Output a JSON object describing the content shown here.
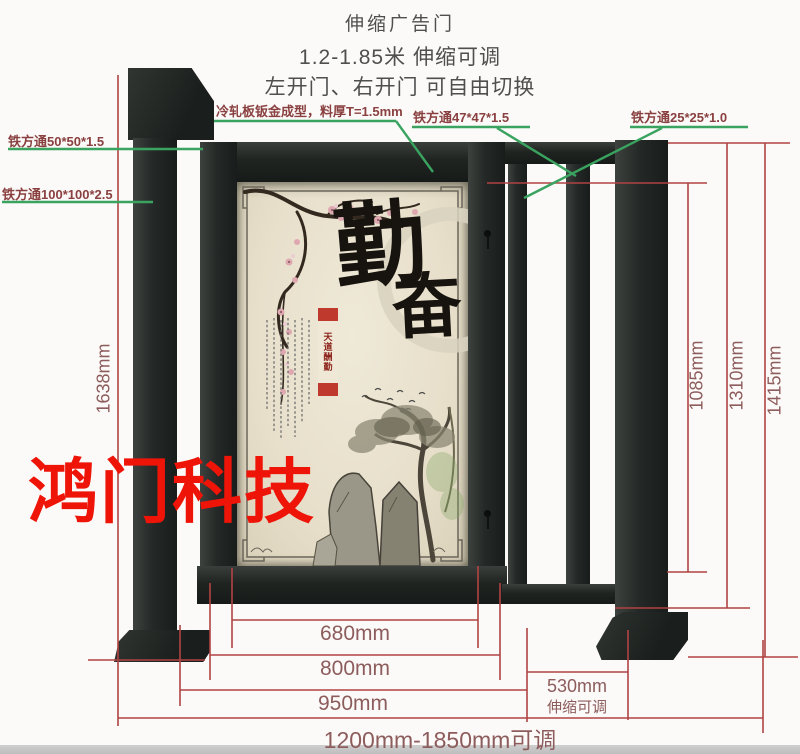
{
  "header": {
    "line1": "伸缩广告门",
    "line2": "1.2-1.85米 伸缩可调",
    "line3": "左开门、右开门 可自由切换"
  },
  "callouts": {
    "tube50": "铁方通50*50*1.5",
    "tube100": "铁方通100*100*2.5",
    "cold_rolled": "冷轧板钣金成型，料厚T=1.5mm",
    "tube47": "铁方通47*47*1.5",
    "tube25": "铁方通25*25*1.0"
  },
  "dimensions": {
    "left_height": "1638mm",
    "right_inner": "1085mm",
    "right_mid": "1310mm",
    "right_outer": "1415mm",
    "panel_width": "680mm",
    "door_width": "800mm",
    "frame_width": "950mm",
    "total_width": "1200mm-1850mm可调",
    "telescopic_width": "530mm",
    "telescopic_note": "伸缩可调"
  },
  "artwork": {
    "char1": "勤",
    "char2": "奋",
    "ribbon": "天道酬勤"
  },
  "watermark": "鸿门科技",
  "colors": {
    "dimension_line": "#b04343",
    "callout_line": "#3aa35f",
    "callout_text": "#8a4040",
    "dimension_text": "#8d5c5c",
    "watermark_red": "#ee1408",
    "metal_dark": "#1f2422",
    "panel_cream": "#e9e2cf"
  }
}
